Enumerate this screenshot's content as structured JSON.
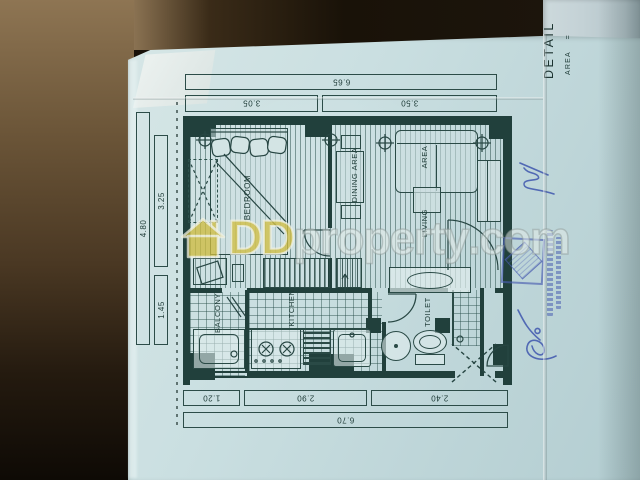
{
  "watermark": {
    "dd": "DD",
    "name": "property",
    "tld": ".com"
  },
  "title_block": {
    "title": "DETAIL",
    "area_label": "AREA",
    "equals_sign": "="
  },
  "rooms": {
    "bedroom": "BEDROOM",
    "dining": "DINING AREA",
    "living_word1": "LIVING",
    "living_word2": "AREA",
    "kitchen": "KITCHEN",
    "balcony": "BALCONY",
    "toilet": "TOILET"
  },
  "dimensions": {
    "right_total": "6.65",
    "right_bedroom": "3.05",
    "right_living": "3.50",
    "left_total": "6.70",
    "left_balcony": "1.20",
    "left_kitchen": "2.90",
    "left_toilet": "2.40",
    "top_total": "4.80",
    "top_bedroom": "3.25",
    "top_service": "1.45"
  },
  "colors": {
    "paper": "#c6dcdf",
    "ink": "#234441",
    "wall_fill": "#21403c",
    "stamp_blue": "#4a5eb0",
    "pen_blue": "#3e56ae",
    "watermark_yellow": "#cebb3e",
    "watermark_gray": "#e4ebe9"
  }
}
